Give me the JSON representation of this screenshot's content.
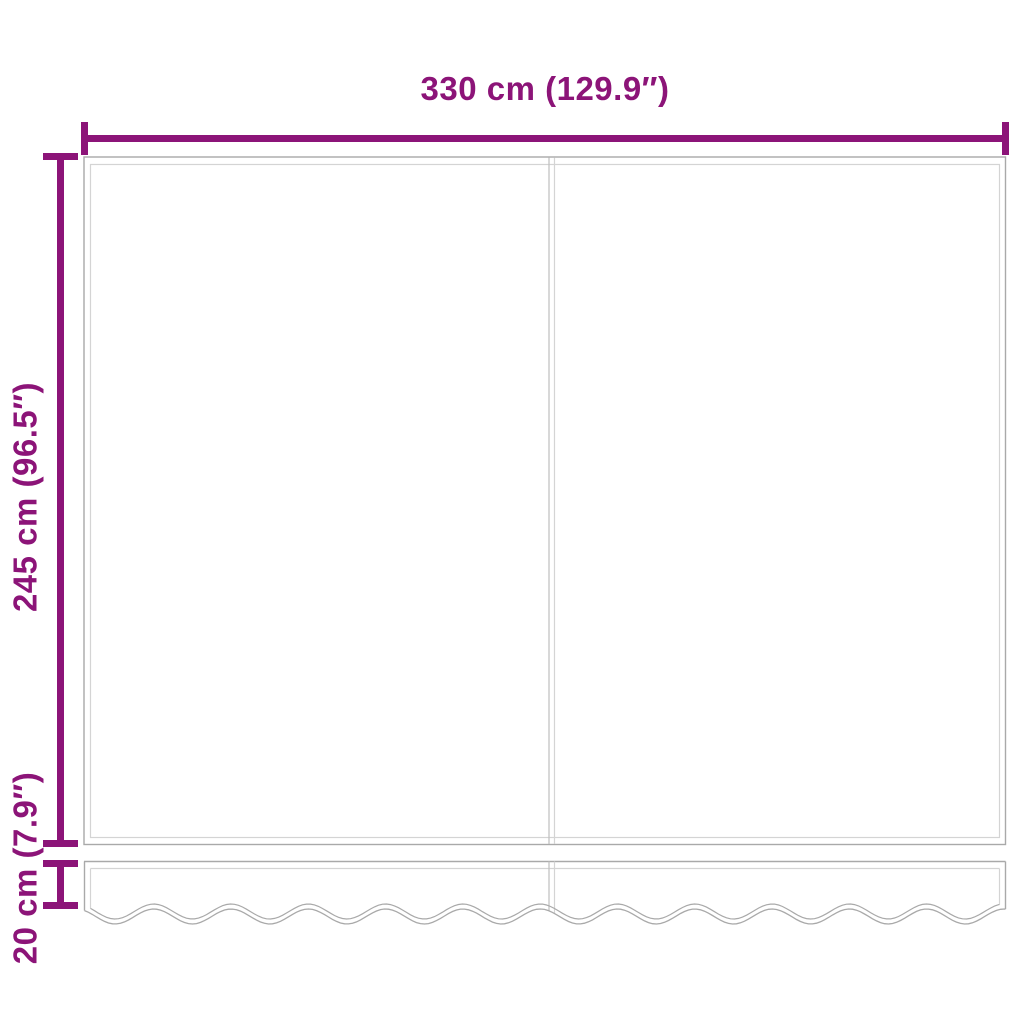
{
  "dimensions": {
    "width": {
      "label": "330 cm (129.9″)"
    },
    "height": {
      "label": "245 cm (96.5″)"
    },
    "valance_height": {
      "label": "20 cm (7.9″)"
    }
  },
  "colors": {
    "dimension_accent": "#8C1478",
    "fabric_outline": "#a9a9a9",
    "fabric_inner_line": "#d4d4d4",
    "fabric_seam_line": "#c2c2c2",
    "background": "#ffffff"
  }
}
